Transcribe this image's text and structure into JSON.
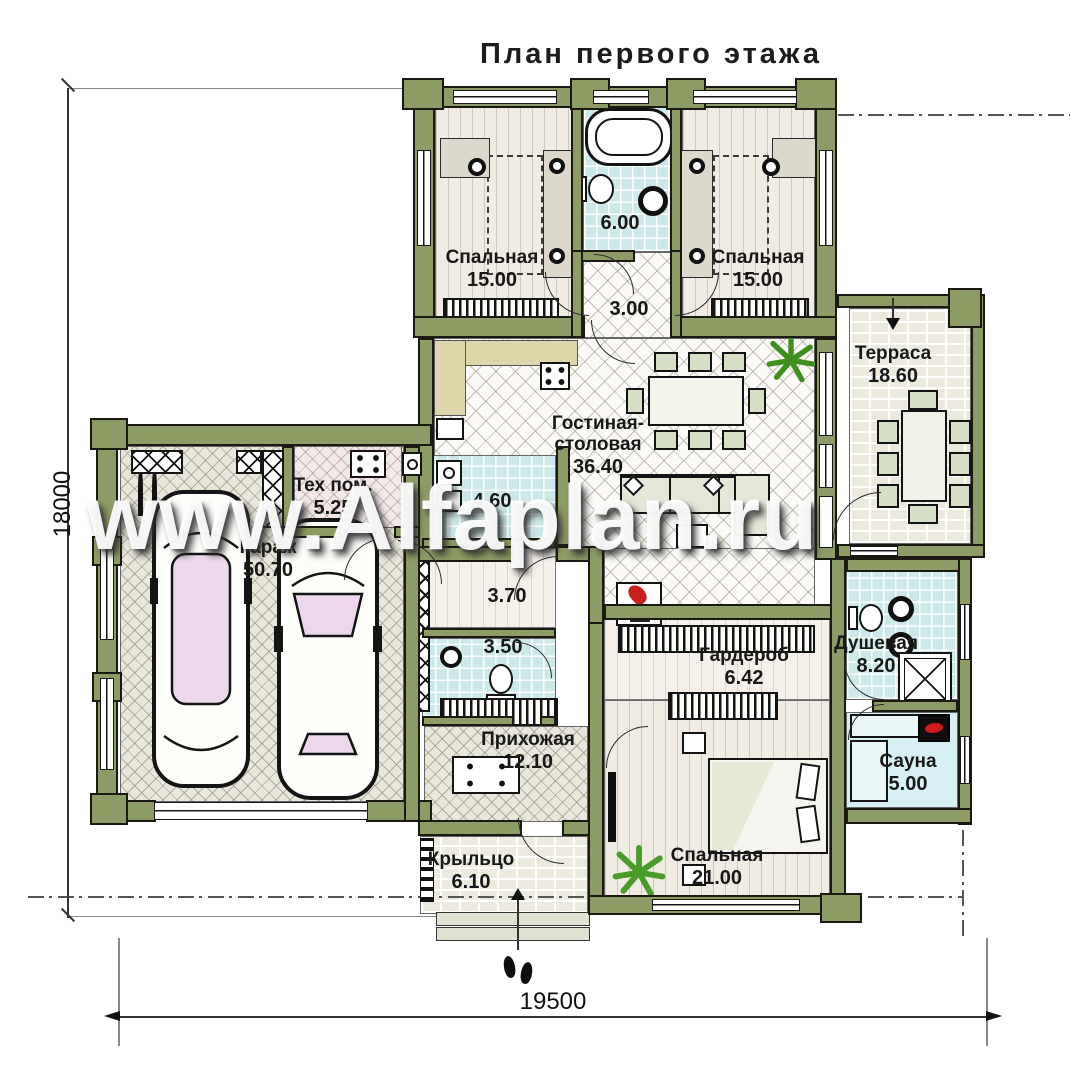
{
  "title": "План первого этажа",
  "watermark": "www.Alfaplan.ru",
  "dimensions": {
    "width_mm": "19500",
    "height_mm": "18000"
  },
  "rooms": {
    "bedroom_tl": {
      "name": "Спальная",
      "area": "15.00"
    },
    "bath": {
      "area": "6.00"
    },
    "hall_top": {
      "area": "3.00"
    },
    "bedroom_tr": {
      "name": "Спальная",
      "area": "15.00"
    },
    "terrace": {
      "name": "Терраса",
      "area": "18.60"
    },
    "living": {
      "name_line1": "Гостиная-",
      "name_line2": "столовая",
      "area": "36.40"
    },
    "tech": {
      "name": "Тех пом.",
      "area": "5.25"
    },
    "garage": {
      "name": "Гараж",
      "area": "50.70"
    },
    "laundry": {
      "area": "4.60"
    },
    "corridor": {
      "area": "3.70"
    },
    "wc": {
      "area": "3.50"
    },
    "hallway": {
      "name": "Прихожая",
      "area": "12.10"
    },
    "wardrobe": {
      "name": "Гардероб",
      "area": "6.42"
    },
    "shower": {
      "name": "Душевая",
      "area": "8.20"
    },
    "sauna": {
      "name": "Сауна",
      "area": "5.00"
    },
    "bedroom_b": {
      "name": "Спальная",
      "area": "21.00"
    },
    "porch": {
      "name": "Крыльцо",
      "area": "6.10"
    }
  },
  "colors": {
    "wall": "#8d9b64",
    "accent_red": "#c8201d",
    "plant_green": "#3f8f1f",
    "tile_blue": "#cde8e8"
  }
}
